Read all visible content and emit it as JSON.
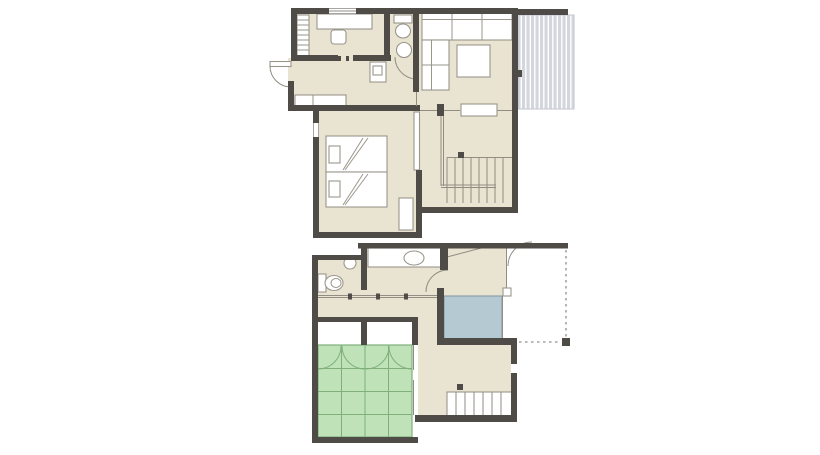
{
  "title": "two-storey-house-floor-plan",
  "palette": {
    "background": "#ffffff",
    "wall": "#4f4b47",
    "floor": "#e9e3d1",
    "thinline": "#918d83",
    "fixline": "#9a968b",
    "tatami": "#bfe2b9",
    "tatamiline": "#7fb07b",
    "water": "#b4c9d1",
    "waterline": "#8da0aa",
    "deck": "#d3d6dd",
    "deckline": "#c3c6ce",
    "dashline": "#8f8f8f"
  },
  "floors": [
    {
      "id": "upper-floor",
      "rooms": [
        "study-room",
        "toilet-room",
        "living-dining-room",
        "wood-deck",
        "hallway",
        "twin-bedroom",
        "stairwell"
      ],
      "fixtures": [
        "desk",
        "chair",
        "bookshelf",
        "toilet",
        "round-sink",
        "washer",
        "counter",
        "l-shaped-sofa",
        "coffee-table",
        "bed",
        "bed",
        "nightstand",
        "stairs",
        "railing",
        "window",
        "door-swing"
      ]
    },
    {
      "id": "lower-floor",
      "rooms": [
        "toilet-room",
        "washroom",
        "entry-hall",
        "bathroom",
        "corridor",
        "tatami-room",
        "closets",
        "stair-hall",
        "porch"
      ],
      "fixtures": [
        "toilet",
        "hand-sink",
        "vanity-counter",
        "vanity-sink",
        "bathtub-area",
        "sliding-doors",
        "tatami-grid",
        "closet-door-swings",
        "stairs",
        "eave-outline",
        "eave-column",
        "door-swing"
      ]
    }
  ]
}
